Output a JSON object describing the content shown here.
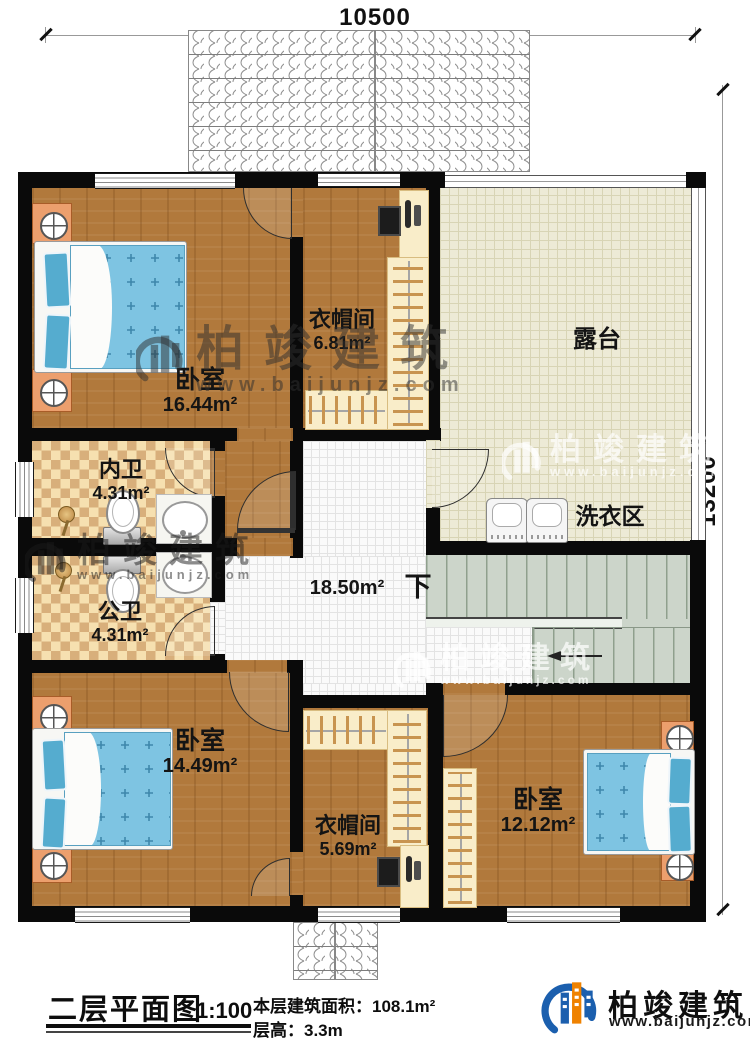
{
  "dimensions": {
    "width_label": "10500",
    "height_label": "13200"
  },
  "rooms": {
    "bedroom_tl": {
      "name": "卧室",
      "area": "16.44m²"
    },
    "closet_top": {
      "name": "衣帽间",
      "area": "6.81m²"
    },
    "terrace": {
      "name": "露台"
    },
    "bath_inner": {
      "name": "内卫",
      "area": "4.31m²"
    },
    "bath_public": {
      "name": "公卫",
      "area": "4.31m²"
    },
    "hallway": {
      "area": "18.50m²",
      "stairs_label": "下"
    },
    "laundry": {
      "name": "洗衣区"
    },
    "bedroom_bl": {
      "name": "卧室",
      "area": "14.49m²"
    },
    "closet_bottom": {
      "name": "衣帽间",
      "area": "5.69m²"
    },
    "bedroom_br": {
      "name": "卧室",
      "area": "12.12m²"
    }
  },
  "watermark": {
    "brand": "柏竣建筑",
    "website": "www.baijunjz.com"
  },
  "title_block": {
    "title": "二层平面图",
    "scale": "1:100",
    "area_text": "本层建筑面积：108.1m²",
    "height_text": "层高：3.3m"
  },
  "brand_footer": {
    "name": "柏竣建筑",
    "website": "www.baijunjz.com"
  },
  "colors": {
    "wall": "#0a0a0a",
    "wood": "#b1793c",
    "bed": "#7ec4e2",
    "brand_blue": "#1b5fae",
    "brand_orange": "#ef8200"
  }
}
